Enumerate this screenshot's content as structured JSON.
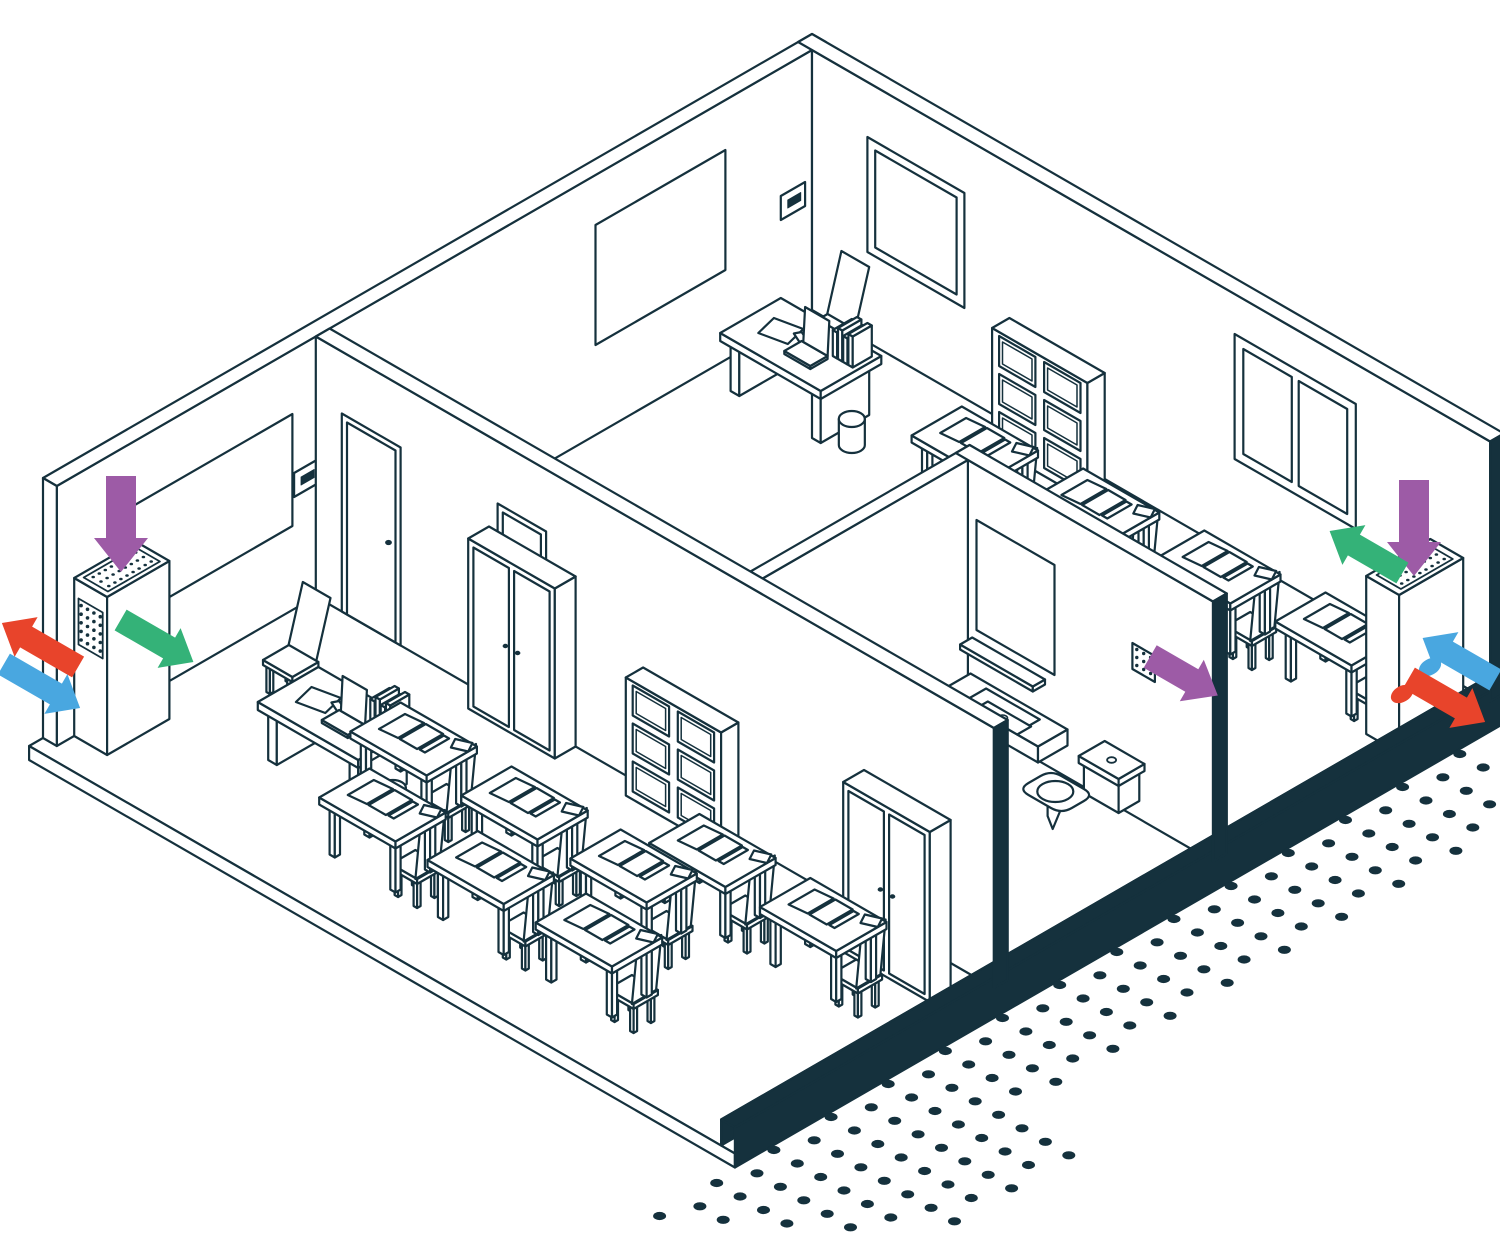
{
  "figure": {
    "label": "Isometric cutaway illustration of a school floor with ventilation units and airflow arrows",
    "style": "white line-art isometric drawing, dark ink outlines"
  },
  "colors": {
    "ink": "#15313d",
    "paper": "#ffffff",
    "arrow_purple": "#9d5ba6",
    "arrow_green": "#34b278",
    "arrow_red": "#e8442b",
    "arrow_blue": "#49a7e0"
  },
  "canvas": {
    "width": 1500,
    "height": 1240,
    "origin_x": 812,
    "origin_y": 310,
    "unit_x": 0.866,
    "unit_y": 0.5,
    "wall_height": 260,
    "stroke_width": 2.2
  },
  "rooms": [
    {
      "name": "classroom-left",
      "contents": "teacher desk, 8 student desks with chairs, 2 wardrobes, cube shelf, whiteboard, wall controller, ventilation unit"
    },
    {
      "name": "office",
      "contents": "desk with laptop and books, chair, wastebasket, whiteboard, wall controller, window"
    },
    {
      "name": "classroom-right",
      "contents": "4 student desks with chairs, cube shelf, window, ventilation unit"
    },
    {
      "name": "bathroom",
      "contents": "sink counter, mirror, shelf, toilet, extract grille"
    }
  ],
  "airflow_legend": [
    {
      "name": "supply-air-down",
      "color_key": "arrow_purple"
    },
    {
      "name": "air-into-room",
      "color_key": "arrow_green"
    },
    {
      "name": "exhaust-air-out",
      "color_key": "arrow_red"
    },
    {
      "name": "fresh-air-in",
      "color_key": "arrow_blue"
    }
  ],
  "items": [
    {
      "t": "slab",
      "name": "floor-slab"
    },
    {
      "t": "wallnw",
      "name": "outer-wall-northwest"
    },
    {
      "t": "wallne",
      "name": "outer-wall-northeast"
    },
    {
      "t": "window",
      "name": "office-window",
      "a0": 64,
      "a1": 176,
      "z0": 90,
      "z1": 205
    },
    {
      "t": "window2",
      "name": "classroom-right-window",
      "a0": 488,
      "a1": 628,
      "z0": 95,
      "z1": 220
    },
    {
      "t": "board",
      "name": "office-whiteboard",
      "b0": 100,
      "b1": 250,
      "z0": 90,
      "z1": 210
    },
    {
      "t": "thermo",
      "name": "office-wall-controller",
      "b": 8,
      "z": 108
    },
    {
      "t": "board",
      "name": "classroom-whiteboard",
      "b0": 600,
      "b1": 790,
      "z0": 84,
      "z1": 196
    },
    {
      "t": "thermo",
      "name": "classroom-wall-controller",
      "b": 570,
      "z": 112
    },
    {
      "t": "chairB",
      "name": "office-chair",
      "a": 44,
      "b": 26
    },
    {
      "t": "tdesk",
      "name": "office-desk",
      "a": 28,
      "b": 64
    },
    {
      "t": "bin",
      "name": "office-wastebasket",
      "a": 158,
      "b": 112
    },
    {
      "t": "shelf",
      "name": "classroom-right-cube-shelf",
      "a": 240,
      "b": 12
    },
    {
      "t": "desk",
      "name": "student-desk",
      "a": 284,
      "b": 96
    },
    {
      "t": "desk",
      "name": "student-desk",
      "a": 416,
      "b": 88
    },
    {
      "t": "desk",
      "name": "student-desk",
      "a": 548,
      "b": 80
    },
    {
      "t": "desk",
      "name": "student-desk",
      "a": 680,
      "b": 72
    },
    {
      "t": "wall4",
      "name": "bathroom-side-wall"
    },
    {
      "t": "wall3",
      "name": "bathroom-back-wall"
    },
    {
      "t": "mirror",
      "name": "bathroom-mirror",
      "a0": 510,
      "a1": 600,
      "z0": 95,
      "z1": 205
    },
    {
      "t": "wshelf",
      "name": "bathroom-shelf",
      "a0": 505,
      "z": 80
    },
    {
      "t": "grille",
      "name": "bathroom-extract-grille",
      "a": 690,
      "z": 146
    },
    {
      "t": "sink",
      "name": "bathroom-sink",
      "a": 505
    },
    {
      "t": "toilet",
      "name": "bathroom-toilet",
      "a": 650,
      "b": 322
    },
    {
      "t": "wall1",
      "name": "classroom-partition-wall"
    },
    {
      "t": "wardrobe",
      "name": "classroom-wardrobe",
      "a": 200,
      "b": 573
    },
    {
      "t": "shelf",
      "name": "classroom-cube-shelf",
      "a": 378,
      "b": 573
    },
    {
      "t": "ventL",
      "name": "ventilation-unit-left",
      "a": 0,
      "b": 780
    },
    {
      "t": "chairB",
      "name": "teacher-chair",
      "a": 64,
      "b": 668
    },
    {
      "t": "tdesk",
      "name": "teacher-desk",
      "a": 130,
      "b": 700
    },
    {
      "t": "bin",
      "name": "classroom-wastebasket",
      "a": 262,
      "b": 746
    },
    {
      "t": "desk",
      "name": "student-desk",
      "a": 256,
      "b": 716
    },
    {
      "t": "desk",
      "name": "student-desk",
      "a": 384,
      "b": 716
    },
    {
      "t": "desk",
      "name": "student-desk",
      "a": 304,
      "b": 800
    },
    {
      "t": "desk",
      "name": "student-desk",
      "a": 540,
      "b": 655
    },
    {
      "t": "desk",
      "name": "student-desk",
      "a": 510,
      "b": 716
    },
    {
      "t": "desk",
      "name": "student-desk",
      "a": 429,
      "b": 800
    },
    {
      "t": "wardrobe",
      "name": "classroom-wardrobe",
      "a": 660,
      "b": 600
    },
    {
      "t": "desk",
      "name": "student-desk",
      "a": 668,
      "b": 655
    },
    {
      "t": "desk",
      "name": "student-desk",
      "a": 554,
      "b": 800
    },
    {
      "t": "ventR",
      "name": "ventilation-unit-right",
      "a": 744,
      "b": 30
    },
    {
      "t": "band",
      "name": "cutaway-wall-edge"
    },
    {
      "t": "dots",
      "name": "halftone-dot-pattern"
    },
    {
      "t": "port",
      "name": "exhaust-air-port",
      "x": 1402,
      "y": 694,
      "color": "arrow_red"
    },
    {
      "t": "port",
      "name": "fresh-air-port",
      "x": 1430,
      "y": 667,
      "color": "arrow_blue"
    },
    {
      "t": "arrow",
      "name": "supply-air-arrow-left-unit",
      "color": "arrow_purple",
      "x": 121,
      "y": 524,
      "ang": 90,
      "len": 96,
      "sw": 30,
      "hw": 54,
      "hl": 34
    },
    {
      "t": "arrow",
      "name": "air-into-room-arrow-left-unit",
      "color": "arrow_green",
      "x": 157,
      "y": 641,
      "ang": 30,
      "len": 84,
      "sw": 24,
      "hw": 46,
      "hl": 28
    },
    {
      "t": "arrow",
      "name": "exhaust-air-arrow-left",
      "color": "arrow_red",
      "x": 40,
      "y": 645,
      "ang": 210,
      "len": 88,
      "sw": 24,
      "hw": 46,
      "hl": 28
    },
    {
      "t": "arrow",
      "name": "fresh-air-arrow-left",
      "color": "arrow_blue",
      "x": 42,
      "y": 686,
      "ang": 30,
      "len": 88,
      "sw": 24,
      "hw": 46,
      "hl": 28
    },
    {
      "t": "arrow",
      "name": "bathroom-extract-arrow",
      "color": "arrow_purple",
      "x": 1184,
      "y": 676,
      "ang": 30,
      "len": 78,
      "sw": 26,
      "hw": 48,
      "hl": 30
    },
    {
      "t": "arrow",
      "name": "supply-air-arrow-right-unit",
      "color": "arrow_purple",
      "x": 1414,
      "y": 528,
      "ang": 90,
      "len": 96,
      "sw": 30,
      "hw": 54,
      "hl": 34
    },
    {
      "t": "arrow",
      "name": "air-into-room-arrow-right-unit",
      "color": "arrow_green",
      "x": 1366,
      "y": 552,
      "ang": 210,
      "len": 84,
      "sw": 24,
      "hw": 46,
      "hl": 28
    },
    {
      "t": "arrow",
      "name": "exhaust-air-arrow-right",
      "color": "arrow_red",
      "x": 1447,
      "y": 700,
      "ang": 30,
      "len": 88,
      "sw": 24,
      "hw": 46,
      "hl": 28
    },
    {
      "t": "arrow",
      "name": "fresh-air-arrow-right",
      "color": "arrow_blue",
      "x": 1459,
      "y": 659,
      "ang": 210,
      "len": 84,
      "sw": 24,
      "hw": 46,
      "hl": 28
    }
  ]
}
